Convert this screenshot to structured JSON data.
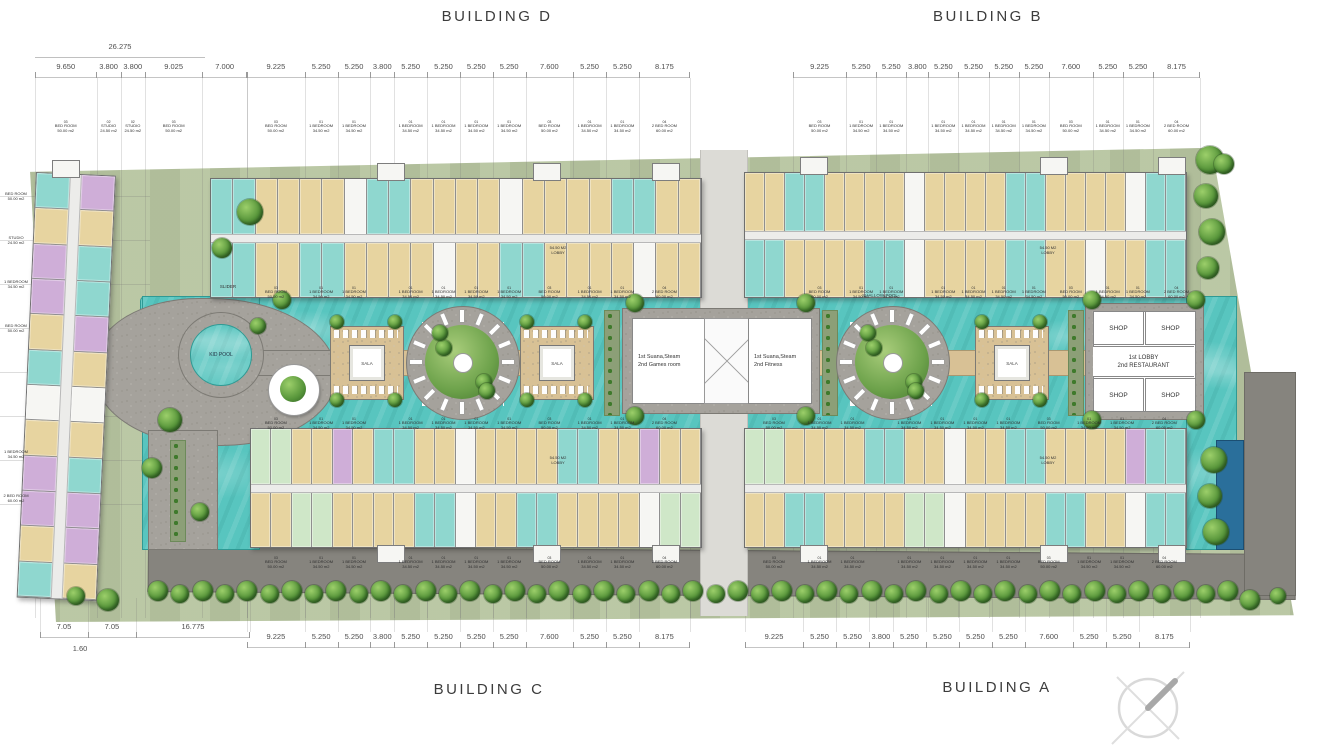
{
  "titles": {
    "building_d": "BUILDING  D",
    "building_b": "BUILDING  B",
    "building_c": "BUILDING C",
    "building_a": "BUILDING  A"
  },
  "dimensions": {
    "top_bracket": "26.275",
    "top_left_group": [
      "9.650",
      "3.800",
      "3.800",
      "9.025",
      "7.000"
    ],
    "module": [
      "9.225",
      "5.250",
      "5.250",
      "3.800",
      "5.250",
      "5.250",
      "5.250",
      "5.250",
      "7.600",
      "5.250",
      "5.250",
      "8.175"
    ],
    "bottom_left_group": [
      "7.05",
      "7.05",
      "16.775"
    ],
    "bottom_offset": "1.60"
  },
  "amenities": {
    "slider": "SLIDER",
    "kid_pool": "KID POOL",
    "sala": "SALA",
    "shallow_pool": "SHALLOW POOL",
    "sauna_games_line1": "1st Suana,Steam",
    "sauna_games_line2": "2nd Games room",
    "sauna_fitness_line1": "1st Suana,Steam",
    "sauna_fitness_line2": "2nd Fitness",
    "shop": "SHOP",
    "lobby_restaurant_line1": "1st LOBBY",
    "lobby_restaurant_line2": "2nd RESTAURANT",
    "lobby_area": "54.50 M2",
    "lobby": "LOBBY"
  },
  "units_legend": [
    {
      "no": "01",
      "name": "1 BEDROOM",
      "area": "34.50 m2"
    },
    {
      "no": "02",
      "name": "STUDIO",
      "area": "24.50 m2"
    },
    {
      "no": "03",
      "name": "BED ROOM",
      "area": "50.00 m2"
    },
    {
      "no": "04",
      "name": "2 BED ROOM",
      "area": "60.00 m2"
    }
  ],
  "micro_map_module": [
    2,
    0,
    0,
    -1,
    0,
    0,
    0,
    0,
    2,
    0,
    0,
    3
  ],
  "micro_map_left": [
    2,
    1,
    1,
    2,
    -1
  ],
  "buildings": {
    "d_top": "ccttttwccttttwttttcctt",
    "d_bottom": "ccttccttttwttccttttwtt",
    "b_top": "ttccttttwttttccttttwcc",
    "b_bottom": "ccttttccwttttccttwttcc",
    "c_top": "ggttptccttwttttccttptt",
    "c_bottom": "ttggttttccwttccttttwgg",
    "a_top": "ggttttccttwttccttttpcc",
    "a_bottom": "ttccttttggwttttccttwcc",
    "west_left": "ctpptcwtpptc",
    "west_right": "ptccptwtcppt"
  },
  "colors": {
    "site_green": "#b7c5a0",
    "water": "#58c5bf",
    "water_dark": "#2a6f9b",
    "deck": "#a5a29c",
    "road": "#86847e",
    "unit_tan": "#e7d4a0",
    "unit_teal": "#8fd7cf",
    "unit_purple": "#cfaed8",
    "unit_green": "#cfe7c8",
    "tree": "#58963b"
  }
}
